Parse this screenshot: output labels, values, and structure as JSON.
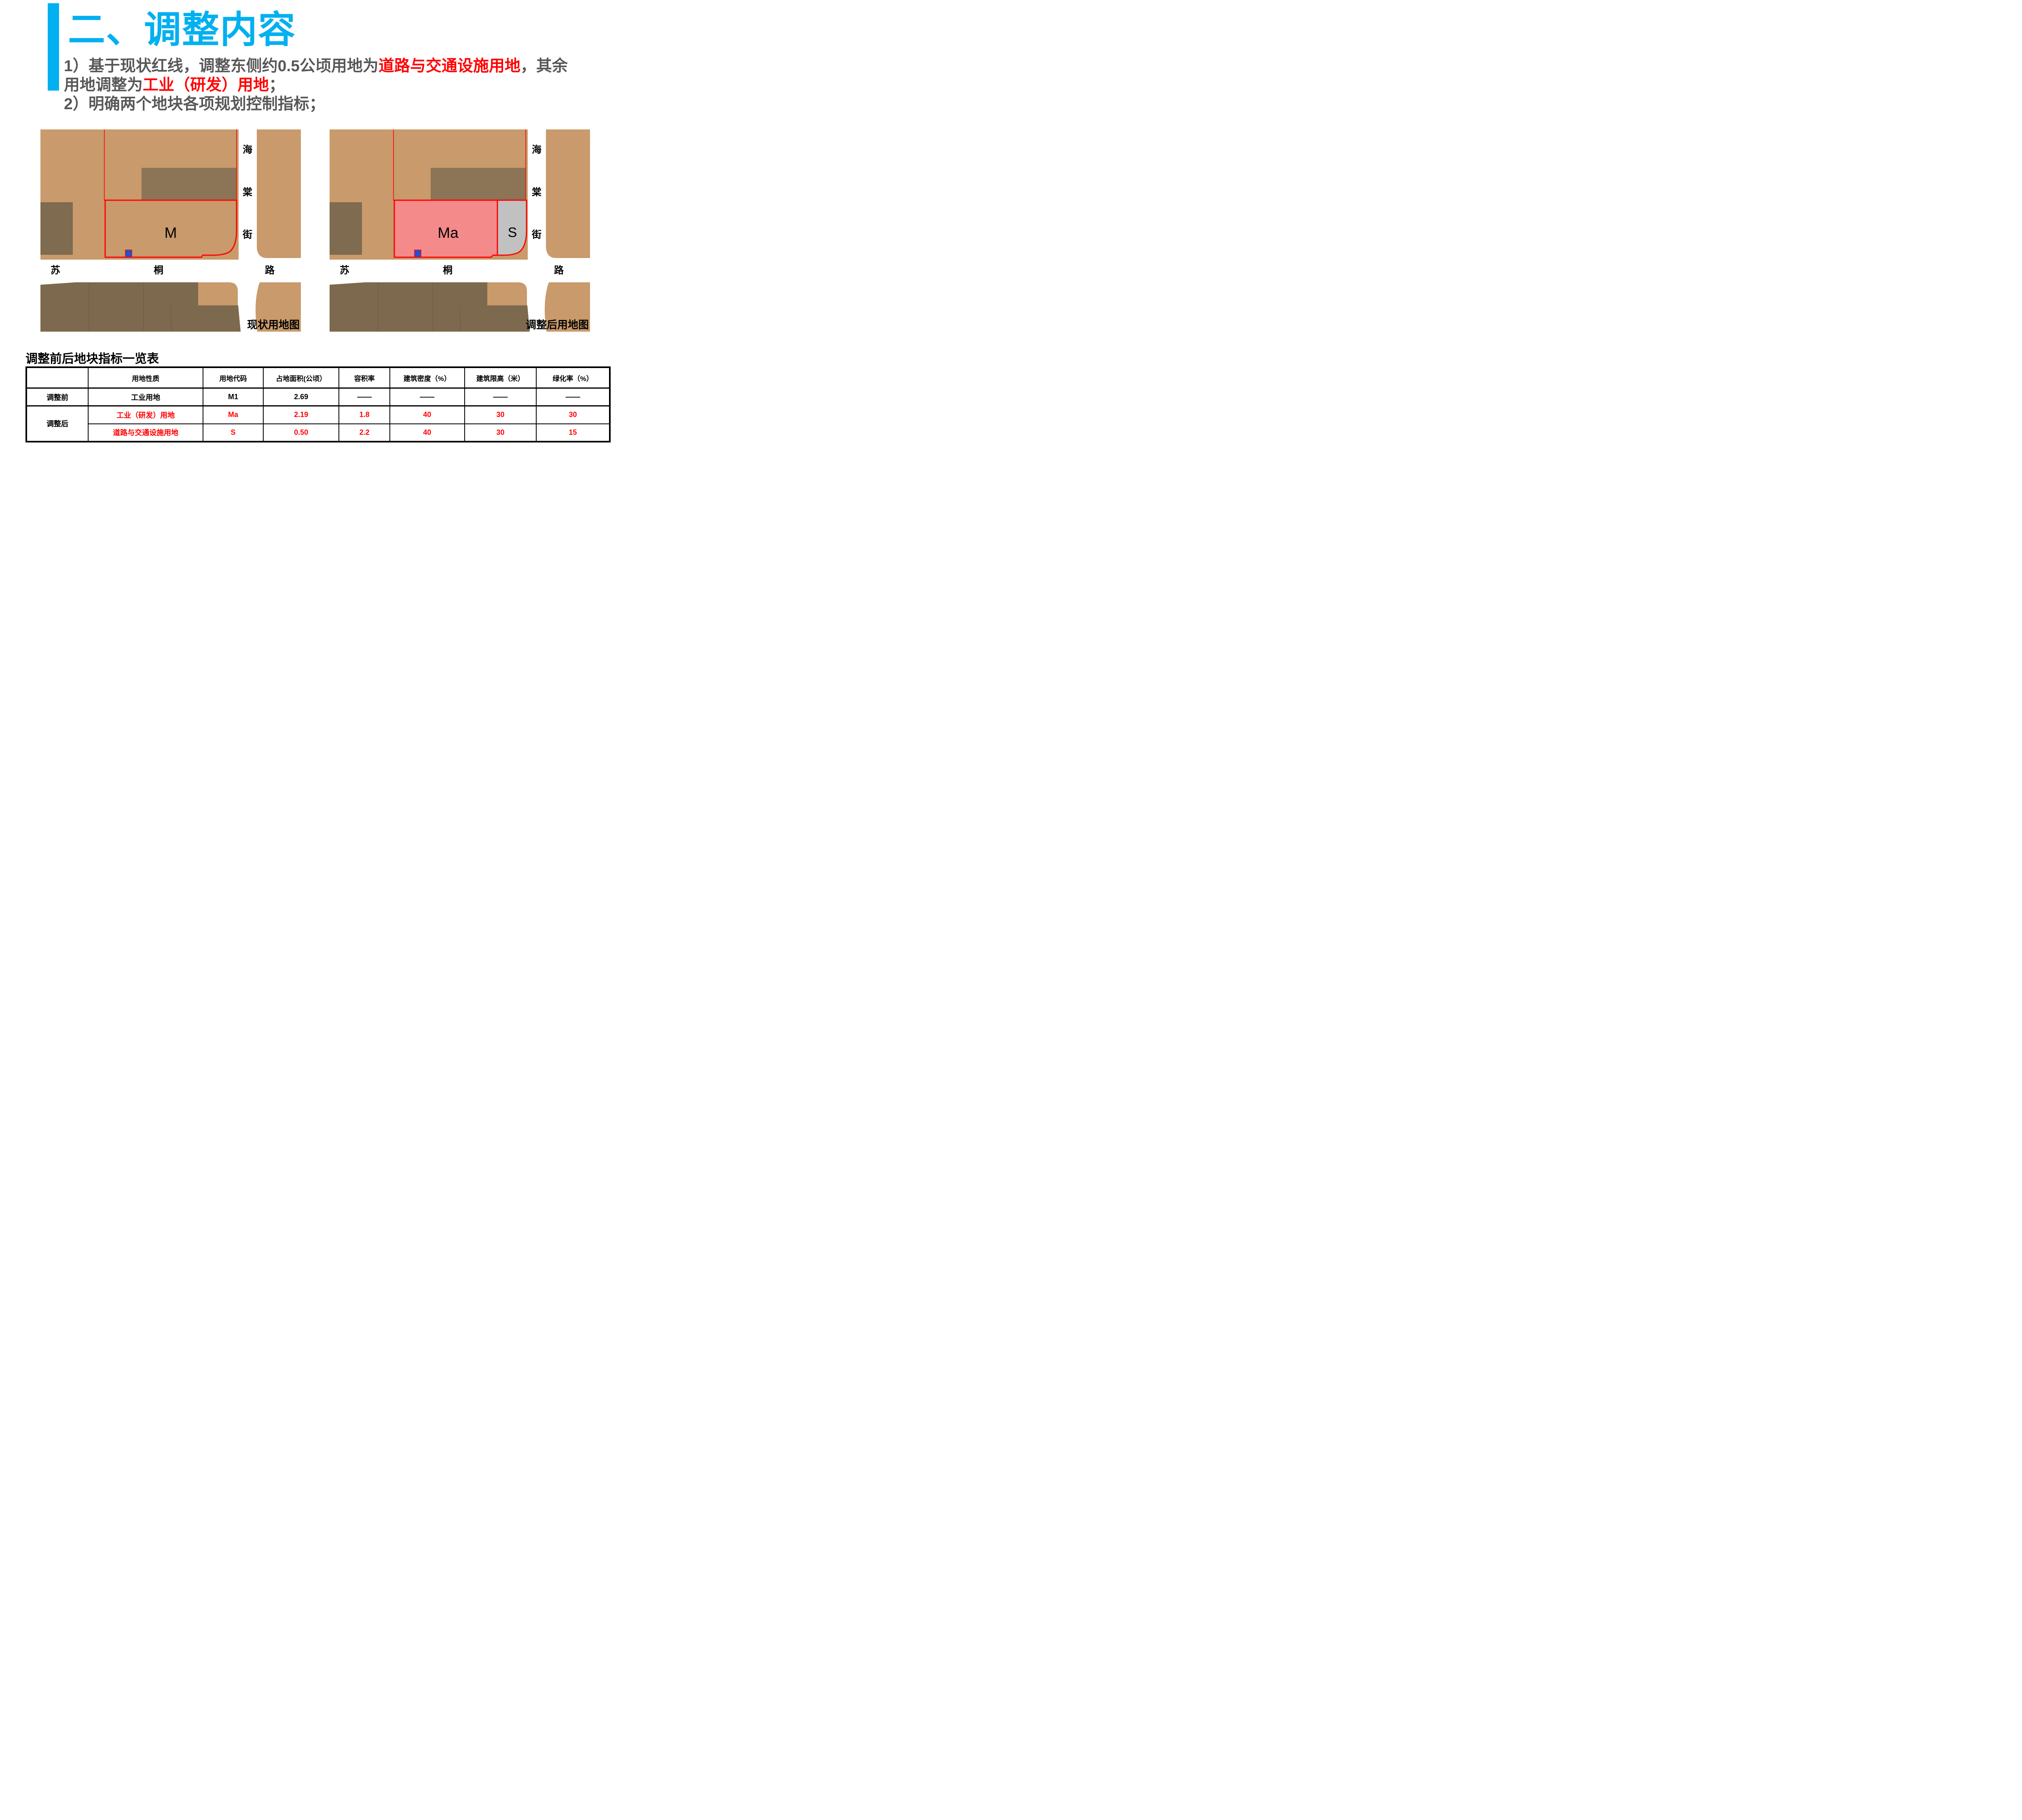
{
  "slide": {
    "title": "二、调整内容",
    "accent_color": "#00B0F0"
  },
  "paragraph": {
    "text_color": "#575757",
    "highlight_color": "#FF0000",
    "lines": [
      {
        "segments": [
          {
            "t": "1）基于现状红线，调整东侧约0.5公顷用地为",
            "hl": false
          },
          {
            "t": "道路与交通设施用地",
            "hl": true
          },
          {
            "t": "，其余",
            "hl": false
          }
        ]
      },
      {
        "segments": [
          {
            "t": "用地调整为",
            "hl": false
          },
          {
            "t": "工业（研发）用地",
            "hl": true
          },
          {
            "t": "；",
            "hl": false
          }
        ]
      },
      {
        "segments": [
          {
            "t": "2）明确两个地块各项规划控制指标；",
            "hl": false
          }
        ]
      }
    ]
  },
  "maps": {
    "colors": {
      "land_tan": "#C99A6B",
      "parcel_bottom_dark": "#7D694E",
      "parcel_block_dark": "#8C7456",
      "parcel_left_dark": "#7E6B50",
      "division_line": "#6E5C45",
      "road_white": "#FFFFFF",
      "boundary_red": "#FF0000",
      "ma_pink": "#F48A8A",
      "s_gray": "#C1C1C1",
      "marker_blue": "#2150D0",
      "label_black": "#000000"
    },
    "vertical_road_labels": [
      "海",
      "棠",
      "街"
    ],
    "horizontal_road_labels": [
      "苏",
      "桐",
      "路"
    ],
    "left": {
      "caption": "现状用地图",
      "parcel_codes": {
        "main": "M"
      }
    },
    "right": {
      "caption": "调整后用地图",
      "parcel_codes": {
        "main": "Ma",
        "side": "S"
      }
    }
  },
  "table": {
    "title": "调整前后地块指标一览表",
    "headers": [
      "",
      "用地性质",
      "用地代码",
      "占地面积(公顷）",
      "容积率",
      "建筑密度（%）",
      "建筑限高（米）",
      "绿化率（%）"
    ],
    "col_widths_pct": [
      10.6,
      19.7,
      10.3,
      13.0,
      8.7,
      12.8,
      12.3,
      12.6
    ],
    "row_groups": [
      {
        "label": "调整前",
        "rows": [
          {
            "cells": [
              "工业用地",
              "M1",
              "2.69",
              "——",
              "——",
              "——",
              "——"
            ],
            "color": "#000000"
          }
        ]
      },
      {
        "label": "调整后",
        "rows": [
          {
            "cells": [
              "工业（研发）用地",
              "Ma",
              "2.19",
              "1.8",
              "40",
              "30",
              "30"
            ],
            "color": "#FF0000"
          },
          {
            "cells": [
              "道路与交通设施用地",
              "S",
              "0.50",
              "2.2",
              "40",
              "30",
              "15"
            ],
            "color": "#FF0000"
          }
        ]
      }
    ]
  }
}
